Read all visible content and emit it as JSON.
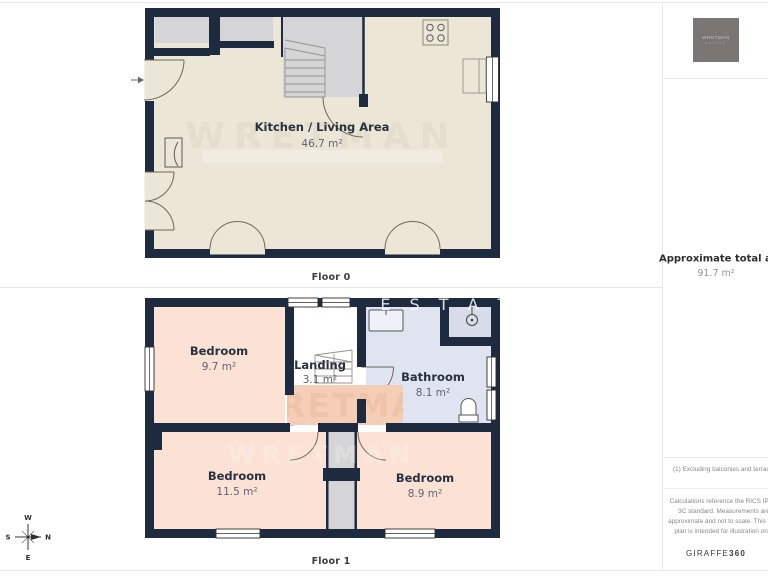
{
  "floors": [
    {
      "caption": "Floor 0",
      "rooms": [
        {
          "name": "Kitchen / Living Area",
          "area": "46.7 m²"
        }
      ]
    },
    {
      "caption": "Floor 1",
      "rooms": [
        {
          "name": "Bedroom",
          "area": "9.7 m²"
        },
        {
          "name": "Landing",
          "area": "3.1 m²"
        },
        {
          "name": "Bathroom",
          "area": "8.1 m²"
        },
        {
          "name": "Bedroom",
          "area": "11.5 m²"
        },
        {
          "name": "Bedroom",
          "area": "8.9 m²"
        }
      ]
    }
  ],
  "sidebar": {
    "logo": {
      "line1": "WRETMAN",
      "line2": "ESTATE"
    },
    "total_area_label": "Approximate total area",
    "total_area_sup": "(1)",
    "total_area_value": "91.7 m²",
    "footnote": "(1) Excluding balconies and terraces",
    "disclaimer": "Calculations reference the RICS IPMS 3C standard. Measurements are approximate and not to scale. This floor plan is intended for illustration only.",
    "brand": {
      "name": "GIRAFFE",
      "suffix": "360"
    }
  },
  "compass": {
    "north": "N",
    "east": "E",
    "south": "S",
    "west": "W"
  },
  "watermark": {
    "name": "WRETMAN",
    "estate": "ESTATE",
    "estate_spaced": "E S T A T E"
  },
  "colors": {
    "wall": "#1e2b3f",
    "floor_cream": "#ece6d7",
    "floor_peach": "#fbe2d4",
    "floor_lavender": "#e0e4f0",
    "shower_gray": "#d8dce8",
    "gray_feature": "#d5d5d7",
    "watermark_salmon": "#f6ceb7",
    "divider": "#e7e7e7"
  }
}
